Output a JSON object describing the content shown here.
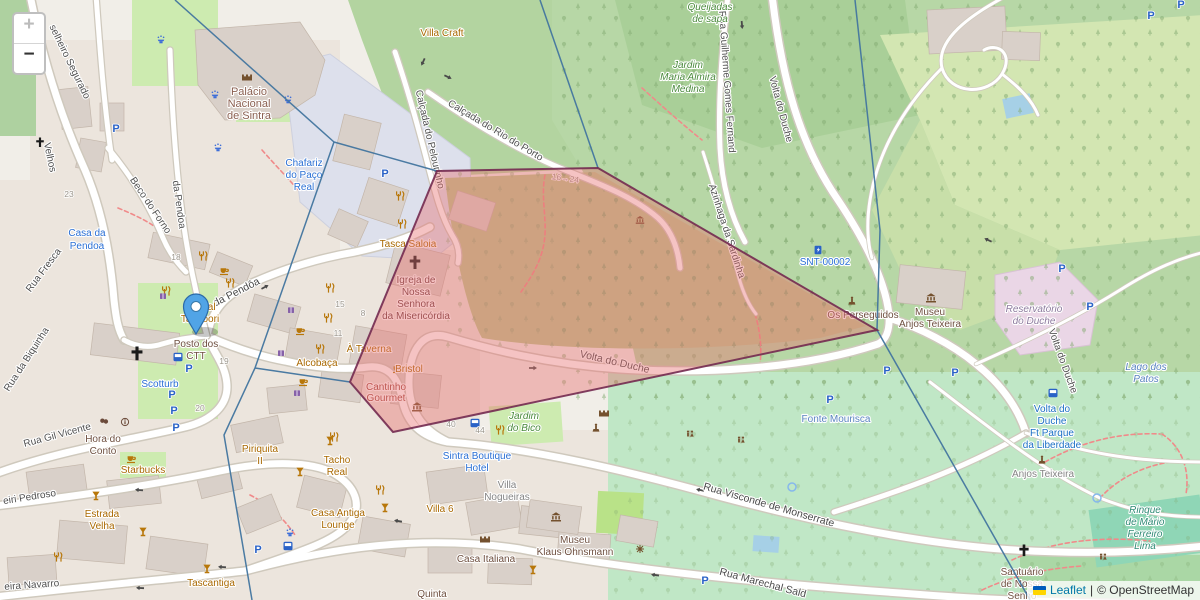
{
  "controls": {
    "zoom_in": "+",
    "zoom_out": "−"
  },
  "attribution": {
    "leaflet": "Leaflet",
    "separator": "|",
    "copyright": "© OpenStreetMap"
  },
  "overlay": {
    "polygon_fill": "#e87070",
    "polygon_stroke": "#732a50",
    "voronoi_line_color": "#42759f",
    "marker": "blue-location-pin"
  },
  "icons": {
    "parking": "P"
  },
  "labels": {
    "streets": {
      "segurado": "selheiro Segurado",
      "velhos": "Velhos",
      "pendoa_v": "da Pendoa",
      "pendoa": "Rua da Pendôa",
      "beco_forno": "Beco do Forno",
      "fresca": "Rua Fresca",
      "biquinha": "Rua da Biquinha",
      "gil_vicente": "Rua Gil Vicente",
      "pedroso": "eiri Pedroso",
      "navarro": "eira Navarro",
      "pelourinho": "Calçada do Pelourinho",
      "rio_porto": "Calçada do Rio do Porto",
      "guilherme": "Rua Guilherme Gomes Fernand",
      "azinhaga": "Azinhaga da Sardinha",
      "volta_duche": "Volta do Duche",
      "visconde": "Rua Visconde de Monserrate",
      "marechal": "Rua Marechal Sald"
    },
    "pois": {
      "villa_craft": "Villa Craft",
      "bengal_1": "Bengal",
      "bengal_2": "Tandoori",
      "tasca": "Tasca Saloia",
      "taverna": "À Taverna",
      "alcobaca": "Alcobaça",
      "bristol": "Bristol",
      "cantinho_1": "Cantinho",
      "cantinho_2": "Gourmet",
      "starbucks": "Starbucks",
      "hora_1": "Hora do",
      "hora_2": "Conto",
      "estrada_1": "Estrada",
      "estrada_2": "Velha",
      "tascantiga": "Tascantiga",
      "piriquita_1": "Piriquita",
      "piriquita_2": "II",
      "tacho_1": "Tacho",
      "tacho_2": "Real",
      "antiga_1": "Casa Antiga",
      "antiga_2": "Lounge",
      "villa6": "Villa 6",
      "italiana": "Casa Italiana",
      "klaus_1": "Museu",
      "klaus_2": "Klaus Ohnsmann",
      "quinta": "Quinta",
      "ctt_1": "Posto dos",
      "ctt_2": "CTT",
      "palacio_1": "Palácio",
      "palacio_2": "Nacional",
      "palacio_3": "de Sintra",
      "igreja_1": "Igreja de",
      "igreja_2": "Nossa",
      "igreja_3": "Senhora",
      "igreja_4": "da Misericórdia",
      "perseguidos": "Os Perseguidos",
      "museu_at_1": "Museu",
      "museu_at_2": "Anjos Teixeira",
      "santuario_1": "Santuário",
      "santuario_2": "de Nossa",
      "santuario_3": "Senho",
      "range_16_24": "16→24"
    },
    "places": {
      "queijadas_1": "Queijadas",
      "queijadas_2": "de sapa",
      "jardim_medina_1": "Jardim",
      "jardim_medina_2": "Maria Almira",
      "jardim_medina_3": "Medina",
      "jardim_bico_1": "Jardim",
      "jardim_bico_2": "do Bico",
      "nogueiras_1": "Villa",
      "nogueiras_2": "Nogueiras",
      "reservatorio_1": "Reservatório",
      "reservatorio_2": "do Duche",
      "anjos_teixeira": "Anjos Teixeira",
      "rinque_1": "Rinque",
      "rinque_2": "de Mário",
      "rinque_3": "Ferreiro",
      "rinque_4": "Lima"
    },
    "water": {
      "fonte": "Fonte Mourisca",
      "lago_1": "Lago dos",
      "lago_2": "Patos"
    },
    "commercial": {
      "scotturb": "Scotturb",
      "casa_pendoa_1": "Casa da",
      "casa_pendoa_2": "Pendoa",
      "chafariz_1": "Chafariz",
      "chafariz_2": "do Paço",
      "chafariz_3": "Real",
      "hotel_1": "Sintra Boutique",
      "hotel_2": "Hotel",
      "snt": "SNT-00002"
    },
    "transit": {
      "stop_volta_1": "Volta do",
      "stop_volta_2": "Duche",
      "stop_volta_3": "Ft Parque",
      "stop_volta_4": "da Liberdade"
    },
    "numbers": {
      "n18": "18",
      "n19": "19",
      "n20": "20",
      "n23": "23",
      "n40": "40",
      "n44": "44",
      "n15": "15",
      "n8": "8",
      "n11": "11"
    }
  }
}
